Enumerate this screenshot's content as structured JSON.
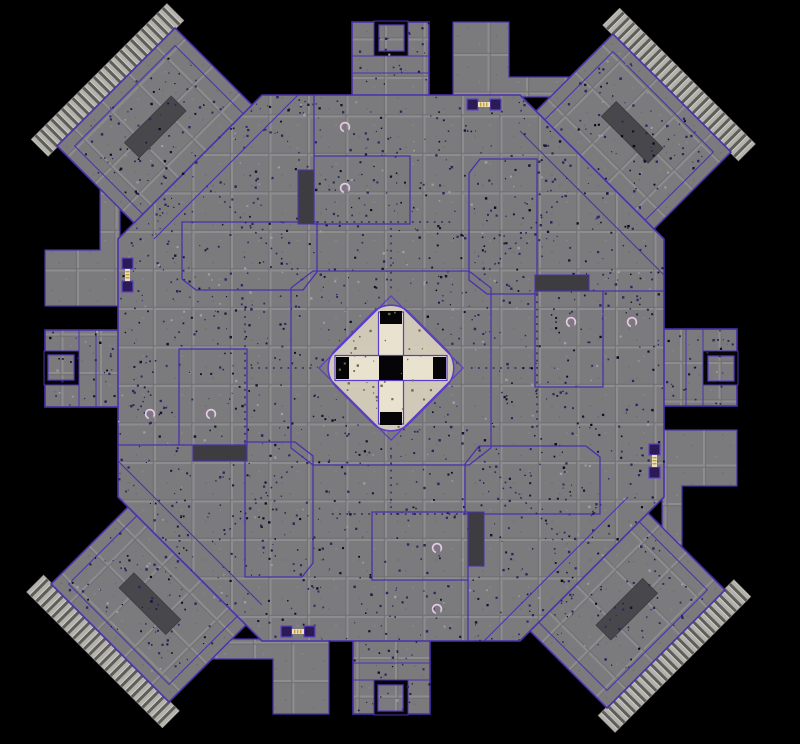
{
  "scene": {
    "kind": "overhead-game-level-map",
    "symmetry": "4-fold rotational",
    "center": {
      "x": 391,
      "y": 368
    },
    "quadrant_names": [
      "nw",
      "ne",
      "se",
      "sw"
    ]
  },
  "colors": {
    "background": "#000000",
    "floor": "#7b7b7e",
    "floor_groove": "#8d8d90",
    "outline": "#4b2fae",
    "outline_bright": "#6647d6",
    "dark_panel": "#48484c",
    "dark_slot": "#3c3c41",
    "pit_black": "#060608",
    "stairs_light": "#b3b2ad",
    "stairs_tread": "#5e5d58",
    "center_base": "#d9d2bd",
    "center_cross": "#e8e2cf",
    "center_outline": "#5b3cc8",
    "marker": "#e6c9e6",
    "marker_core": "#8a6d8a",
    "pad_square": "#2a1a56",
    "pad_square_border": "#6243c6",
    "pad_strip": "#e8e0c0",
    "pad_strip_dash": "#c79a35",
    "speckle_dark": "#2e2660",
    "speckle_deep": "#171233",
    "speckle_black": "#0b0918",
    "speckle_light": "#9fa0a6",
    "speckle_center": "#6f6852"
  },
  "markers": {
    "icon": "item-marker",
    "count": 8,
    "positions": [
      {
        "x": 345,
        "y": 127
      },
      {
        "x": 345,
        "y": 188
      },
      {
        "x": 632,
        "y": 322
      },
      {
        "x": 571,
        "y": 322
      },
      {
        "x": 437,
        "y": 609
      },
      {
        "x": 437,
        "y": 548
      },
      {
        "x": 150,
        "y": 414
      },
      {
        "x": 211,
        "y": 414
      }
    ]
  },
  "jump_pads": {
    "icon": "pad-pair",
    "count": 4,
    "positions": [
      {
        "x": 127.5,
        "y": 275,
        "orient": "v"
      },
      {
        "x": 484,
        "y": 104.5,
        "orient": "h"
      },
      {
        "x": 654.5,
        "y": 461,
        "orient": "v"
      },
      {
        "x": 298,
        "y": 631.5,
        "orient": "h"
      }
    ]
  },
  "structure": {
    "corner_platforms": 4,
    "edge_protrusions": 4,
    "rooms_per_quadrant": 2,
    "dark_ramps": 4,
    "dark_slots": 4,
    "central_cross_pits": 5
  }
}
